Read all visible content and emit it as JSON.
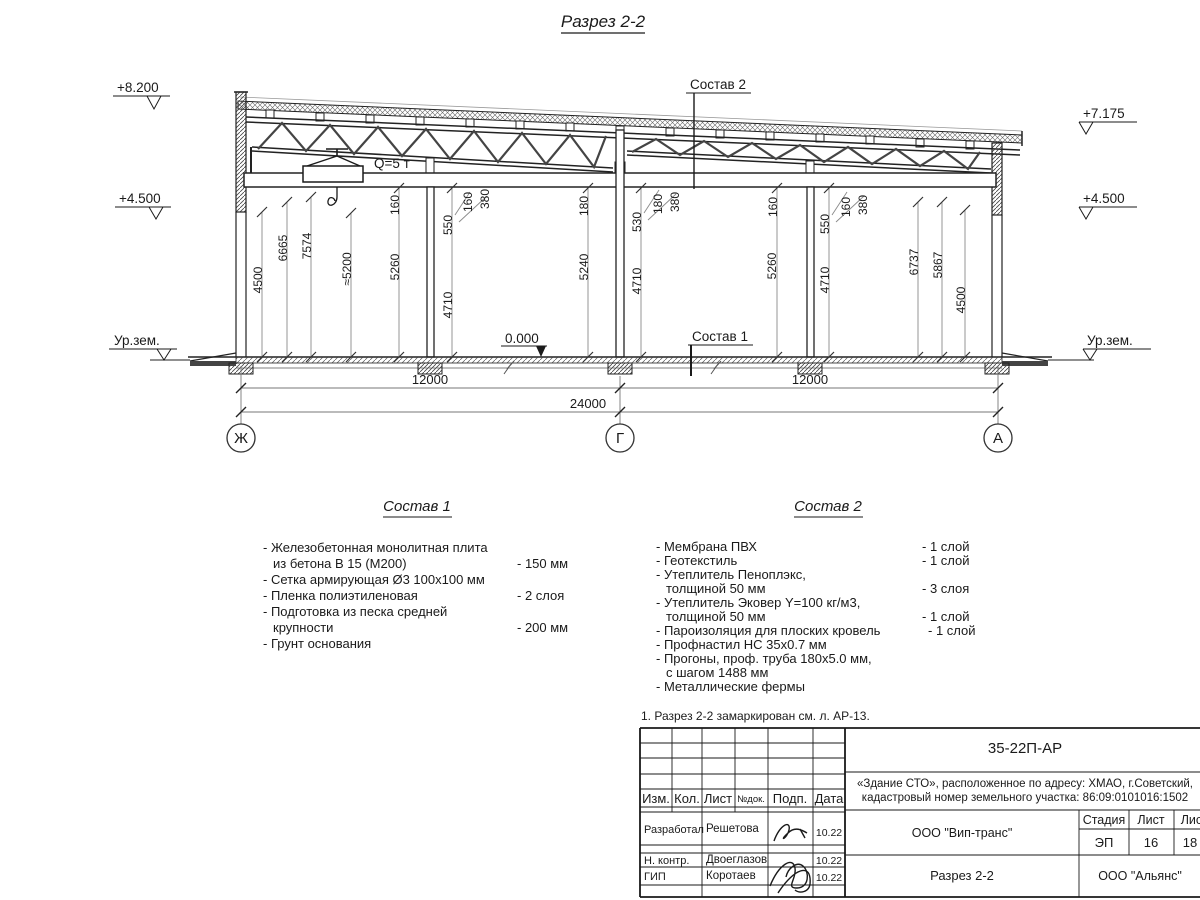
{
  "page": {
    "title": "Разрез 2-2"
  },
  "drawing": {
    "elev_8200": "+8.200",
    "elev_4500_left": "+4.500",
    "elev_7175": "+7.175",
    "elev_4500_right": "+4.500",
    "elev_zero": "0.000",
    "ground_left": "Ур.зем.",
    "ground_right": "Ур.зем.",
    "crane_label": "Q=5 т",
    "callout1": "Состав 1",
    "callout2": "Состав 2",
    "axis_left": "Ж",
    "axis_center": "Г",
    "axis_right": "А",
    "dim_span_left": "12000",
    "dim_span_right": "12000",
    "dim_total": "24000",
    "vdims": [
      "4500",
      "6665",
      "7574",
      "≈5200",
      "160",
      "5260",
      "550",
      "160",
      "380",
      "4710",
      "180",
      "5240",
      "530",
      "180",
      "380",
      "4710",
      "160",
      "5260",
      "550",
      "160",
      "380",
      "4710",
      "6737",
      "5867",
      "4500"
    ]
  },
  "sostav1": {
    "title": "Состав 1",
    "items": [
      {
        "l1": "- Железобетонная  монолитная плита",
        "l2": "из бетона В 15 (М200)",
        "v": "- 150 мм"
      },
      {
        "l1": "- Сетка армирующая Ø3 100х100 мм",
        "l2": "",
        "v": ""
      },
      {
        "l1": "- Пленка полиэтиленовая",
        "l2": "",
        "v": "- 2 слоя"
      },
      {
        "l1": "- Подготовка из песка средней",
        "l2": "крупности",
        "v": "- 200 мм"
      },
      {
        "l1": "- Грунт основания",
        "l2": "",
        "v": ""
      }
    ]
  },
  "sostav2": {
    "title": "Состав 2",
    "items": [
      {
        "l1": "- Мембрана ПВХ",
        "l2": "",
        "v": "- 1 слой"
      },
      {
        "l1": "- Геотекстиль",
        "l2": "",
        "v": "- 1 слой"
      },
      {
        "l1": "- Утеплитель Пеноплэкс,",
        "l2": "толщиной 50 мм",
        "v": "- 3 слоя"
      },
      {
        "l1": "- Утеплитель Эковер Y=100 кг/м3,",
        "l2": "толщиной 50 мм",
        "v": "- 1 слой"
      },
      {
        "l1": "- Пароизоляция для плоских кровель",
        "l2": "",
        "v": "- 1 слой"
      },
      {
        "l1": "- Профнастил НС 35х0.7 мм",
        "l2": "",
        "v": ""
      },
      {
        "l1": "- Прогоны, проф. труба 180х5.0 мм,",
        "l2": "с шагом 1488 мм",
        "v": ""
      },
      {
        "l1": "- Металлические фермы",
        "l2": "",
        "v": ""
      }
    ]
  },
  "note": "1. Разрез 2-2 замаркирован см. л. АР-13.",
  "title_block": {
    "doc_code": "35-22П-АР",
    "project_line1": "«Здание СТО», расположенное по адресу: ХМАО, г.Советский,",
    "project_line2": "кадастровый номер земельного участка: 86:09:0101016:1502",
    "col_izm": "Изм.",
    "col_kol": "Кол.",
    "col_list": "Лист",
    "col_ndok": "№док.",
    "col_podp": "Подп.",
    "col_data": "Дата",
    "rows": [
      {
        "role": "Разработал",
        "name": "Решетова",
        "date": "10.22"
      },
      {
        "role": "Н. контр.",
        "name": "Двоеглазов",
        "date": "10.22"
      },
      {
        "role": "ГИП",
        "name": "Коротаев",
        "date": "10.22"
      }
    ],
    "org_center": "ООО \"Вип-транс\"",
    "stage_label": "Стадия",
    "sheet_label": "Лист",
    "sheets_label": "Листов",
    "stage": "ЭП",
    "sheet": "16",
    "sheets": "18",
    "drawing_name": "Разрез 2-2",
    "org_right": "ООО \"Альянс\""
  }
}
